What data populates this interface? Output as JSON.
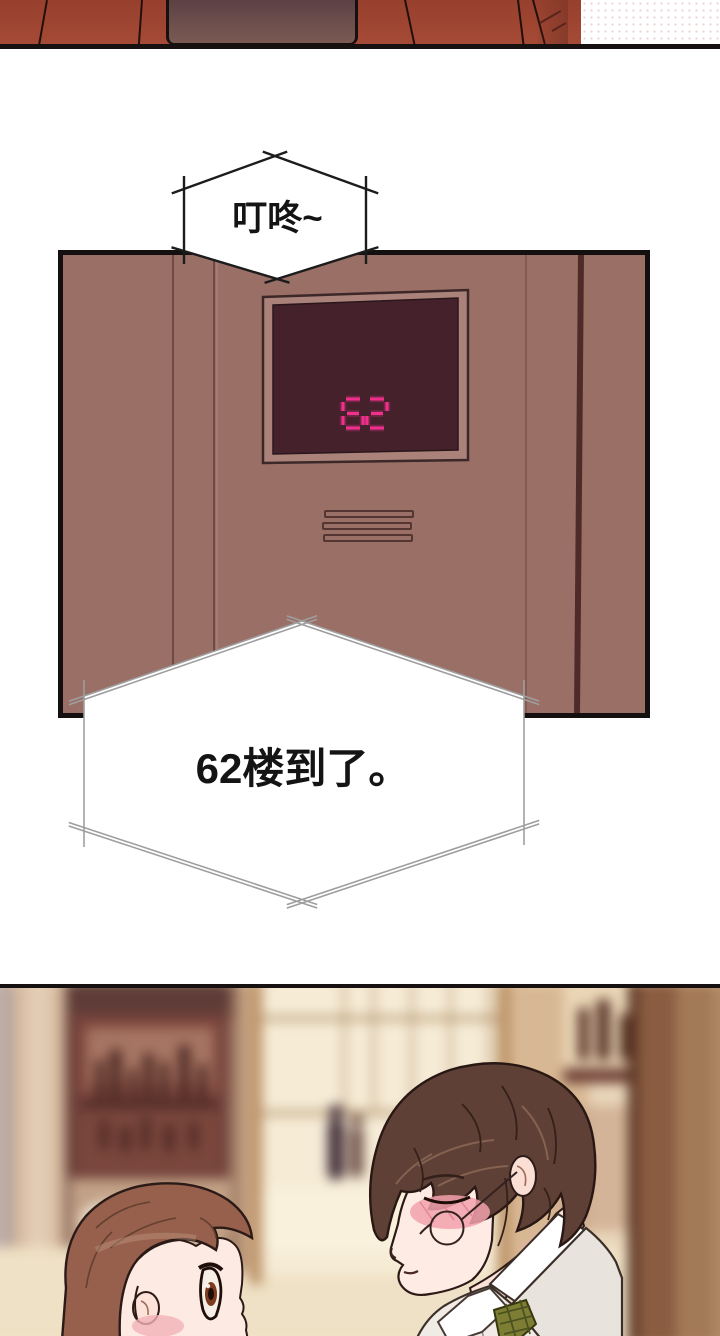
{
  "sfx_bubble": {
    "text": "叮咚~",
    "fill": "#ffffff",
    "stroke": "#1c1c1c"
  },
  "dialog_bubble": {
    "text": "62楼到了。",
    "fill": "#ffffff",
    "stroke": "#9e9e9e"
  },
  "elevator": {
    "display": {
      "floor": "62",
      "digit_color": "#f12f8d",
      "screen_color": "#45222b",
      "frame_color": "#aa8279"
    },
    "wall_color": "#9a6f66",
    "grille_slat_count": 3
  },
  "colors": {
    "jacket_red": "#9e4432",
    "jacket_back_panel": "#5c4144",
    "panel_outline": "#141010",
    "bubble_outline_dark": "#1c1c1c",
    "bubble_outline_light": "#9e9e9e",
    "lobby_warm": "#e9d6ba",
    "hair_dark_brown": "#5e4037",
    "hair_auburn": "#96604d",
    "blush_pink": "#f2a1ad",
    "tie_olive": "#7d7d33",
    "shirt_white": "#ffffff"
  }
}
